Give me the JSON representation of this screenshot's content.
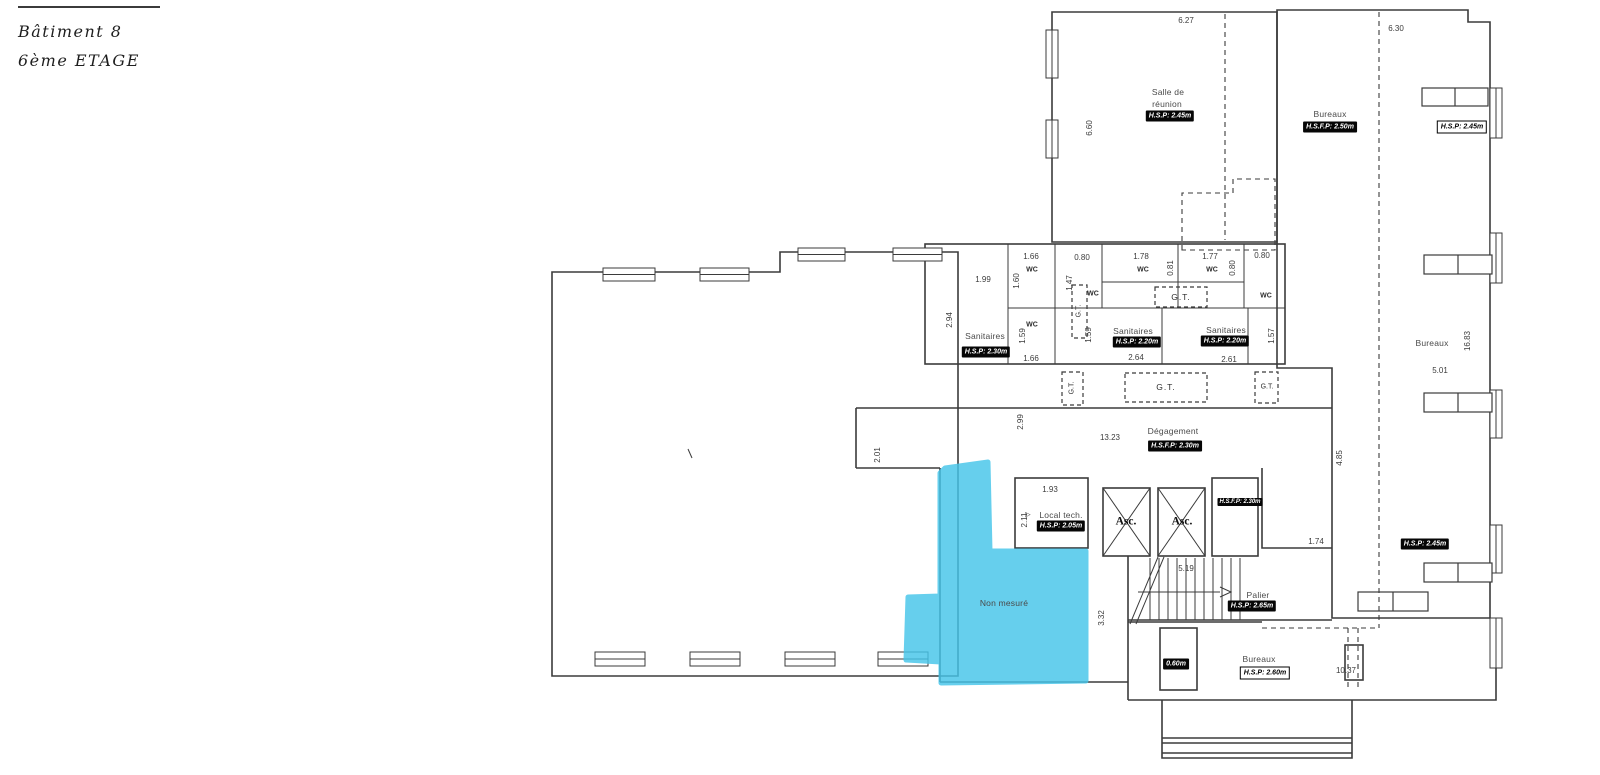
{
  "title": {
    "building": "Bâtiment 8",
    "floor": "6ème ETAGE"
  },
  "colors": {
    "highlight": "#45c5ea",
    "line": "#3b3b3b",
    "badge_bg": "#060606",
    "badge_text": "#ffffff"
  },
  "highlight_region": {
    "label": "Non mesuré"
  },
  "labels": [
    {
      "name": "dim-6-27",
      "text": "6.27",
      "x": 1186,
      "y": 21,
      "cls": "dim"
    },
    {
      "name": "dim-6-60",
      "text": "6.60",
      "x": 1090,
      "y": 128,
      "cls": "dim rot"
    },
    {
      "name": "dim-6-30",
      "text": "6.30",
      "x": 1396,
      "y": 29,
      "cls": "dim"
    },
    {
      "name": "dim-1-99",
      "text": "1.99",
      "x": 983,
      "y": 280,
      "cls": "dim"
    },
    {
      "name": "dim-2-94",
      "text": "2.94",
      "x": 950,
      "y": 320,
      "cls": "dim rot"
    },
    {
      "name": "dim-1-66-top",
      "text": "1.66",
      "x": 1031,
      "y": 257,
      "cls": "dim"
    },
    {
      "name": "dim-1-60",
      "text": "1.60",
      "x": 1017,
      "y": 281,
      "cls": "dim rot"
    },
    {
      "name": "dim-0-80-a",
      "text": "0.80",
      "x": 1082,
      "y": 258,
      "cls": "dim"
    },
    {
      "name": "dim-1-47",
      "text": "1.47",
      "x": 1070,
      "y": 283,
      "cls": "dim rot"
    },
    {
      "name": "dim-1-78",
      "text": "1.78",
      "x": 1141,
      "y": 257,
      "cls": "dim"
    },
    {
      "name": "dim-0-81",
      "text": "0.81",
      "x": 1171,
      "y": 268,
      "cls": "dim rot"
    },
    {
      "name": "dim-1-77",
      "text": "1.77",
      "x": 1210,
      "y": 257,
      "cls": "dim"
    },
    {
      "name": "dim-0-80-b",
      "text": "0.80",
      "x": 1233,
      "y": 268,
      "cls": "dim rot"
    },
    {
      "name": "dim-0-80-c",
      "text": "0.80",
      "x": 1262,
      "y": 256,
      "cls": "dim"
    },
    {
      "name": "dim-1-57",
      "text": "1.57",
      "x": 1272,
      "y": 336,
      "cls": "dim rot"
    },
    {
      "name": "dim-1-59-a",
      "text": "1.59",
      "x": 1023,
      "y": 336,
      "cls": "dim rot"
    },
    {
      "name": "dim-1-59-b",
      "text": "1.59",
      "x": 1089,
      "y": 335,
      "cls": "dim rot"
    },
    {
      "name": "dim-1-66-bottom",
      "text": "1.66",
      "x": 1031,
      "y": 359,
      "cls": "dim"
    },
    {
      "name": "dim-2-64",
      "text": "2.64",
      "x": 1136,
      "y": 358,
      "cls": "dim"
    },
    {
      "name": "dim-2-61",
      "text": "2.61",
      "x": 1229,
      "y": 360,
      "cls": "dim"
    },
    {
      "name": "dim-2-99",
      "text": "2.99",
      "x": 1021,
      "y": 422,
      "cls": "dim rot"
    },
    {
      "name": "dim-2-01",
      "text": "2.01",
      "x": 878,
      "y": 455,
      "cls": "dim rot"
    },
    {
      "name": "dim-13-23",
      "text": "13.23",
      "x": 1110,
      "y": 438,
      "cls": "dim"
    },
    {
      "name": "dim-1-93",
      "text": "1.93",
      "x": 1050,
      "y": 490,
      "cls": "dim"
    },
    {
      "name": "dim-2-11",
      "text": "2.11",
      "x": 1025,
      "y": 520,
      "cls": "dim rot"
    },
    {
      "name": "dim-4-85",
      "text": "4.85",
      "x": 1340,
      "y": 458,
      "cls": "dim rot"
    },
    {
      "name": "dim-1-74",
      "text": "1.74",
      "x": 1316,
      "y": 542,
      "cls": "dim"
    },
    {
      "name": "dim-5-19",
      "text": "5.19",
      "x": 1186,
      "y": 569,
      "cls": "dim"
    },
    {
      "name": "dim-3-32",
      "text": "3.32",
      "x": 1102,
      "y": 618,
      "cls": "dim rot"
    },
    {
      "name": "dim-10-37",
      "text": "10.37",
      "x": 1346,
      "y": 671,
      "cls": "dim"
    },
    {
      "name": "dim-5-01",
      "text": "5.01",
      "x": 1440,
      "y": 371,
      "cls": "dim"
    },
    {
      "name": "dim-16-83",
      "text": "16.83",
      "x": 1468,
      "y": 341,
      "cls": "dim rot"
    },
    {
      "name": "room-salle-de-reunion-line1",
      "text": "Salle de",
      "x": 1168,
      "y": 92,
      "cls": "room"
    },
    {
      "name": "room-salle-de-reunion-line2",
      "text": "réunion",
      "x": 1167,
      "y": 104,
      "cls": "room"
    },
    {
      "name": "room-bureaux-top",
      "text": "Bureaux",
      "x": 1330,
      "y": 114,
      "cls": "room"
    },
    {
      "name": "room-sanitaires-left",
      "text": "Sanitaires",
      "x": 985,
      "y": 336,
      "cls": "room"
    },
    {
      "name": "room-sanitaires-mid",
      "text": "Sanitaires",
      "x": 1133,
      "y": 331,
      "cls": "room"
    },
    {
      "name": "room-sanitaires-right",
      "text": "Sanitaires",
      "x": 1226,
      "y": 330,
      "cls": "room"
    },
    {
      "name": "room-degagement",
      "text": "Dégagement",
      "x": 1173,
      "y": 431,
      "cls": "room"
    },
    {
      "name": "room-local-tech",
      "text": "Local tech.",
      "x": 1061,
      "y": 515,
      "cls": "room"
    },
    {
      "name": "room-palier",
      "text": "Palier",
      "x": 1258,
      "y": 595,
      "cls": "room"
    },
    {
      "name": "room-bureaux-bottom",
      "text": "Bureaux",
      "x": 1259,
      "y": 659,
      "cls": "room"
    },
    {
      "name": "room-bureaux-right",
      "text": "Bureaux",
      "x": 1432,
      "y": 343,
      "cls": "room"
    },
    {
      "name": "room-non-mesure",
      "text": "Non mesuré",
      "x": 1004,
      "y": 603,
      "cls": "room"
    },
    {
      "name": "wc-label-a",
      "text": "WC",
      "x": 1032,
      "y": 270,
      "cls": "wc"
    },
    {
      "name": "wc-label-b",
      "text": "WC",
      "x": 1093,
      "y": 294,
      "cls": "wc"
    },
    {
      "name": "wc-label-c",
      "text": "WC",
      "x": 1143,
      "y": 270,
      "cls": "wc"
    },
    {
      "name": "wc-label-d",
      "text": "WC",
      "x": 1212,
      "y": 270,
      "cls": "wc"
    },
    {
      "name": "wc-label-e",
      "text": "WC",
      "x": 1266,
      "y": 296,
      "cls": "wc"
    },
    {
      "name": "wc-label-f",
      "text": "WC",
      "x": 1032,
      "y": 325,
      "cls": "wc"
    },
    {
      "name": "gt-label-wc-row",
      "text": "G.T.",
      "x": 1181,
      "y": 297,
      "cls": "gt"
    },
    {
      "name": "gt-label-wc-vertical",
      "text": "G.T.",
      "x": 1079,
      "y": 311,
      "cls": "gt-small rot"
    },
    {
      "name": "gt-label-corridor-left",
      "text": "G.T.",
      "x": 1072,
      "y": 388,
      "cls": "gt-small rot"
    },
    {
      "name": "gt-label-corridor-mid",
      "text": "G.T.",
      "x": 1166,
      "y": 387,
      "cls": "gt"
    },
    {
      "name": "gt-label-corridor-right",
      "text": "G.T.",
      "x": 1267,
      "y": 387,
      "cls": "gt-small"
    },
    {
      "name": "elevator-label-1",
      "text": "Asc.",
      "x": 1126,
      "y": 522,
      "cls": "asc"
    },
    {
      "name": "elevator-label-2",
      "text": "Asc.",
      "x": 1182,
      "y": 522,
      "cls": "asc"
    },
    {
      "name": "badge-salle-de-reunion",
      "text": "H.S.P: 2.45m",
      "x": 1170,
      "y": 116,
      "cls": "badge-dark"
    },
    {
      "name": "badge-bureaux-top",
      "text": "H.S.F.P: 2.50m",
      "x": 1330,
      "y": 127,
      "cls": "badge-dark"
    },
    {
      "name": "badge-bureaux-top-right",
      "text": "H.S.P: 2.45m",
      "x": 1462,
      "y": 127,
      "cls": "badge-light"
    },
    {
      "name": "badge-sanitaires-left",
      "text": "H.S.P: 2.30m",
      "x": 986,
      "y": 352,
      "cls": "badge-dark"
    },
    {
      "name": "badge-sanitaires-mid",
      "text": "H.S.P: 2.20m",
      "x": 1137,
      "y": 342,
      "cls": "badge-dark"
    },
    {
      "name": "badge-sanitaires-right",
      "text": "H.S.P: 2.20m",
      "x": 1225,
      "y": 341,
      "cls": "badge-dark"
    },
    {
      "name": "badge-degagement",
      "text": "H.S.F.P: 2.30m",
      "x": 1175,
      "y": 446,
      "cls": "badge-dark"
    },
    {
      "name": "badge-local-tech",
      "text": "H.S.P: 2.05m",
      "x": 1061,
      "y": 526,
      "cls": "badge-dark"
    },
    {
      "name": "badge-asc-corridor",
      "text": "H.S.F.P: 2.30m",
      "x": 1240,
      "y": 502,
      "cls": "badge-dark badge-xs"
    },
    {
      "name": "badge-palier",
      "text": "H.S.P: 2.65m",
      "x": 1252,
      "y": 606,
      "cls": "badge-dark"
    },
    {
      "name": "badge-0-60m",
      "text": "0.60m",
      "x": 1176,
      "y": 664,
      "cls": "badge-dark"
    },
    {
      "name": "badge-bureaux-right",
      "text": "H.S.P: 2.45m",
      "x": 1425,
      "y": 544,
      "cls": "badge-dark"
    },
    {
      "name": "badge-bureaux-bottom",
      "text": "H.S.P: 2.60m",
      "x": 1265,
      "y": 673,
      "cls": "badge-light"
    },
    {
      "name": "door-arrow-local-tech",
      "text": "▷",
      "x": 1028,
      "y": 515,
      "cls": "arrow"
    }
  ]
}
